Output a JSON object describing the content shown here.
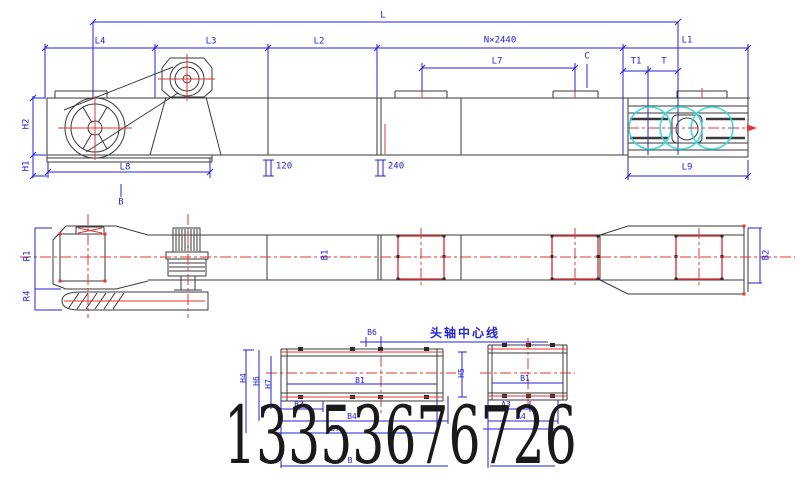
{
  "phone_watermark": "13353676726",
  "colors": {
    "dimension_blue": "#2323d6",
    "object_dark": "#3a3a3a",
    "centerline_red": "#e23535",
    "highlight_cyan": "#35d6d6",
    "phone_black": "#1a1a1a"
  },
  "top_view": {
    "labels": {
      "overall": "L",
      "l4": "L4",
      "l3": "L3",
      "l2": "L2",
      "pitch": "N×2440",
      "l1": "L1",
      "l7": "L7",
      "c": "C",
      "t1": "T1",
      "t": "T",
      "h2": "H2",
      "h1": "H1",
      "l8": "L8",
      "section_b": "B",
      "d120": "120",
      "d240": "240",
      "l9": "L9"
    }
  },
  "plan_view": {
    "labels": {
      "r1": "R1",
      "r4": "R4",
      "b1": "B1",
      "b2": "B2"
    }
  },
  "section_left": {
    "axis_note": "头轴中心线",
    "labels": {
      "b6": "B6",
      "h4": "H4",
      "h6": "H6",
      "h7": "H7",
      "h5": "H5",
      "inner": "B1",
      "b3": "B3",
      "b4": "B4",
      "b7": "B7",
      "b": "B"
    }
  },
  "section_right": {
    "labels": {
      "inner": "B1",
      "a3": "A3",
      "a4": "A4",
      "a": "A"
    }
  }
}
